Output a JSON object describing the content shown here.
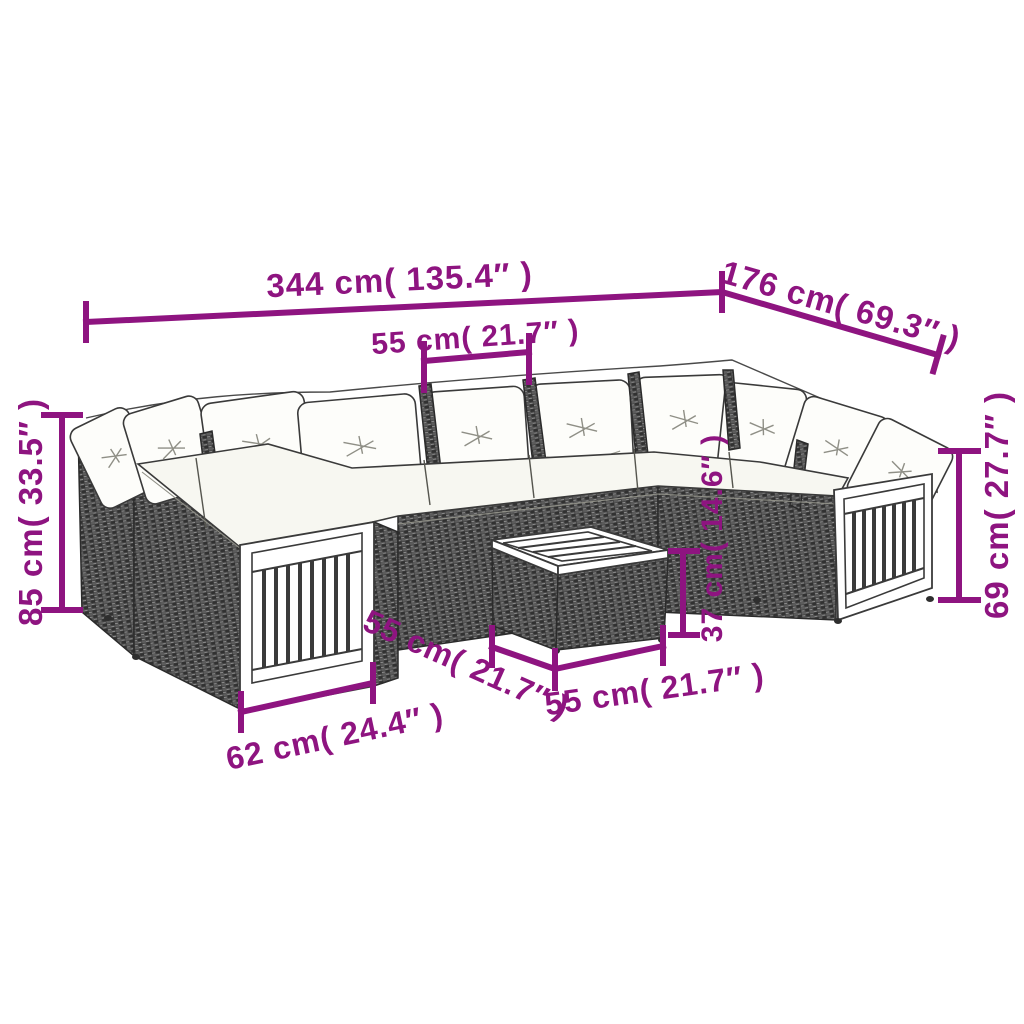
{
  "subject": "U-shaped poly rattan garden lounge set with white cushions, wood slat arm panels and square coffee table",
  "colors": {
    "dimension_accent": "#8E1480",
    "rattan": "#474747",
    "cushion": "#fdfdfa",
    "background": "#ffffff"
  },
  "dims": {
    "overall_width": "344 cm( 135.4″ )",
    "overall_depth": "176 cm( 69.3″ )",
    "seat_width": "55 cm( 21.7″ )",
    "back_height": "85 cm( 33.5″ )",
    "arm_height": "69 cm( 27.7″ )",
    "table_height": "37 cm( 14.6″ )",
    "table_depth": "55 cm( 21.7″ )",
    "table_width": "55 cm( 21.7″ )",
    "arm_panel_width": "62 cm( 24.4″ )"
  }
}
